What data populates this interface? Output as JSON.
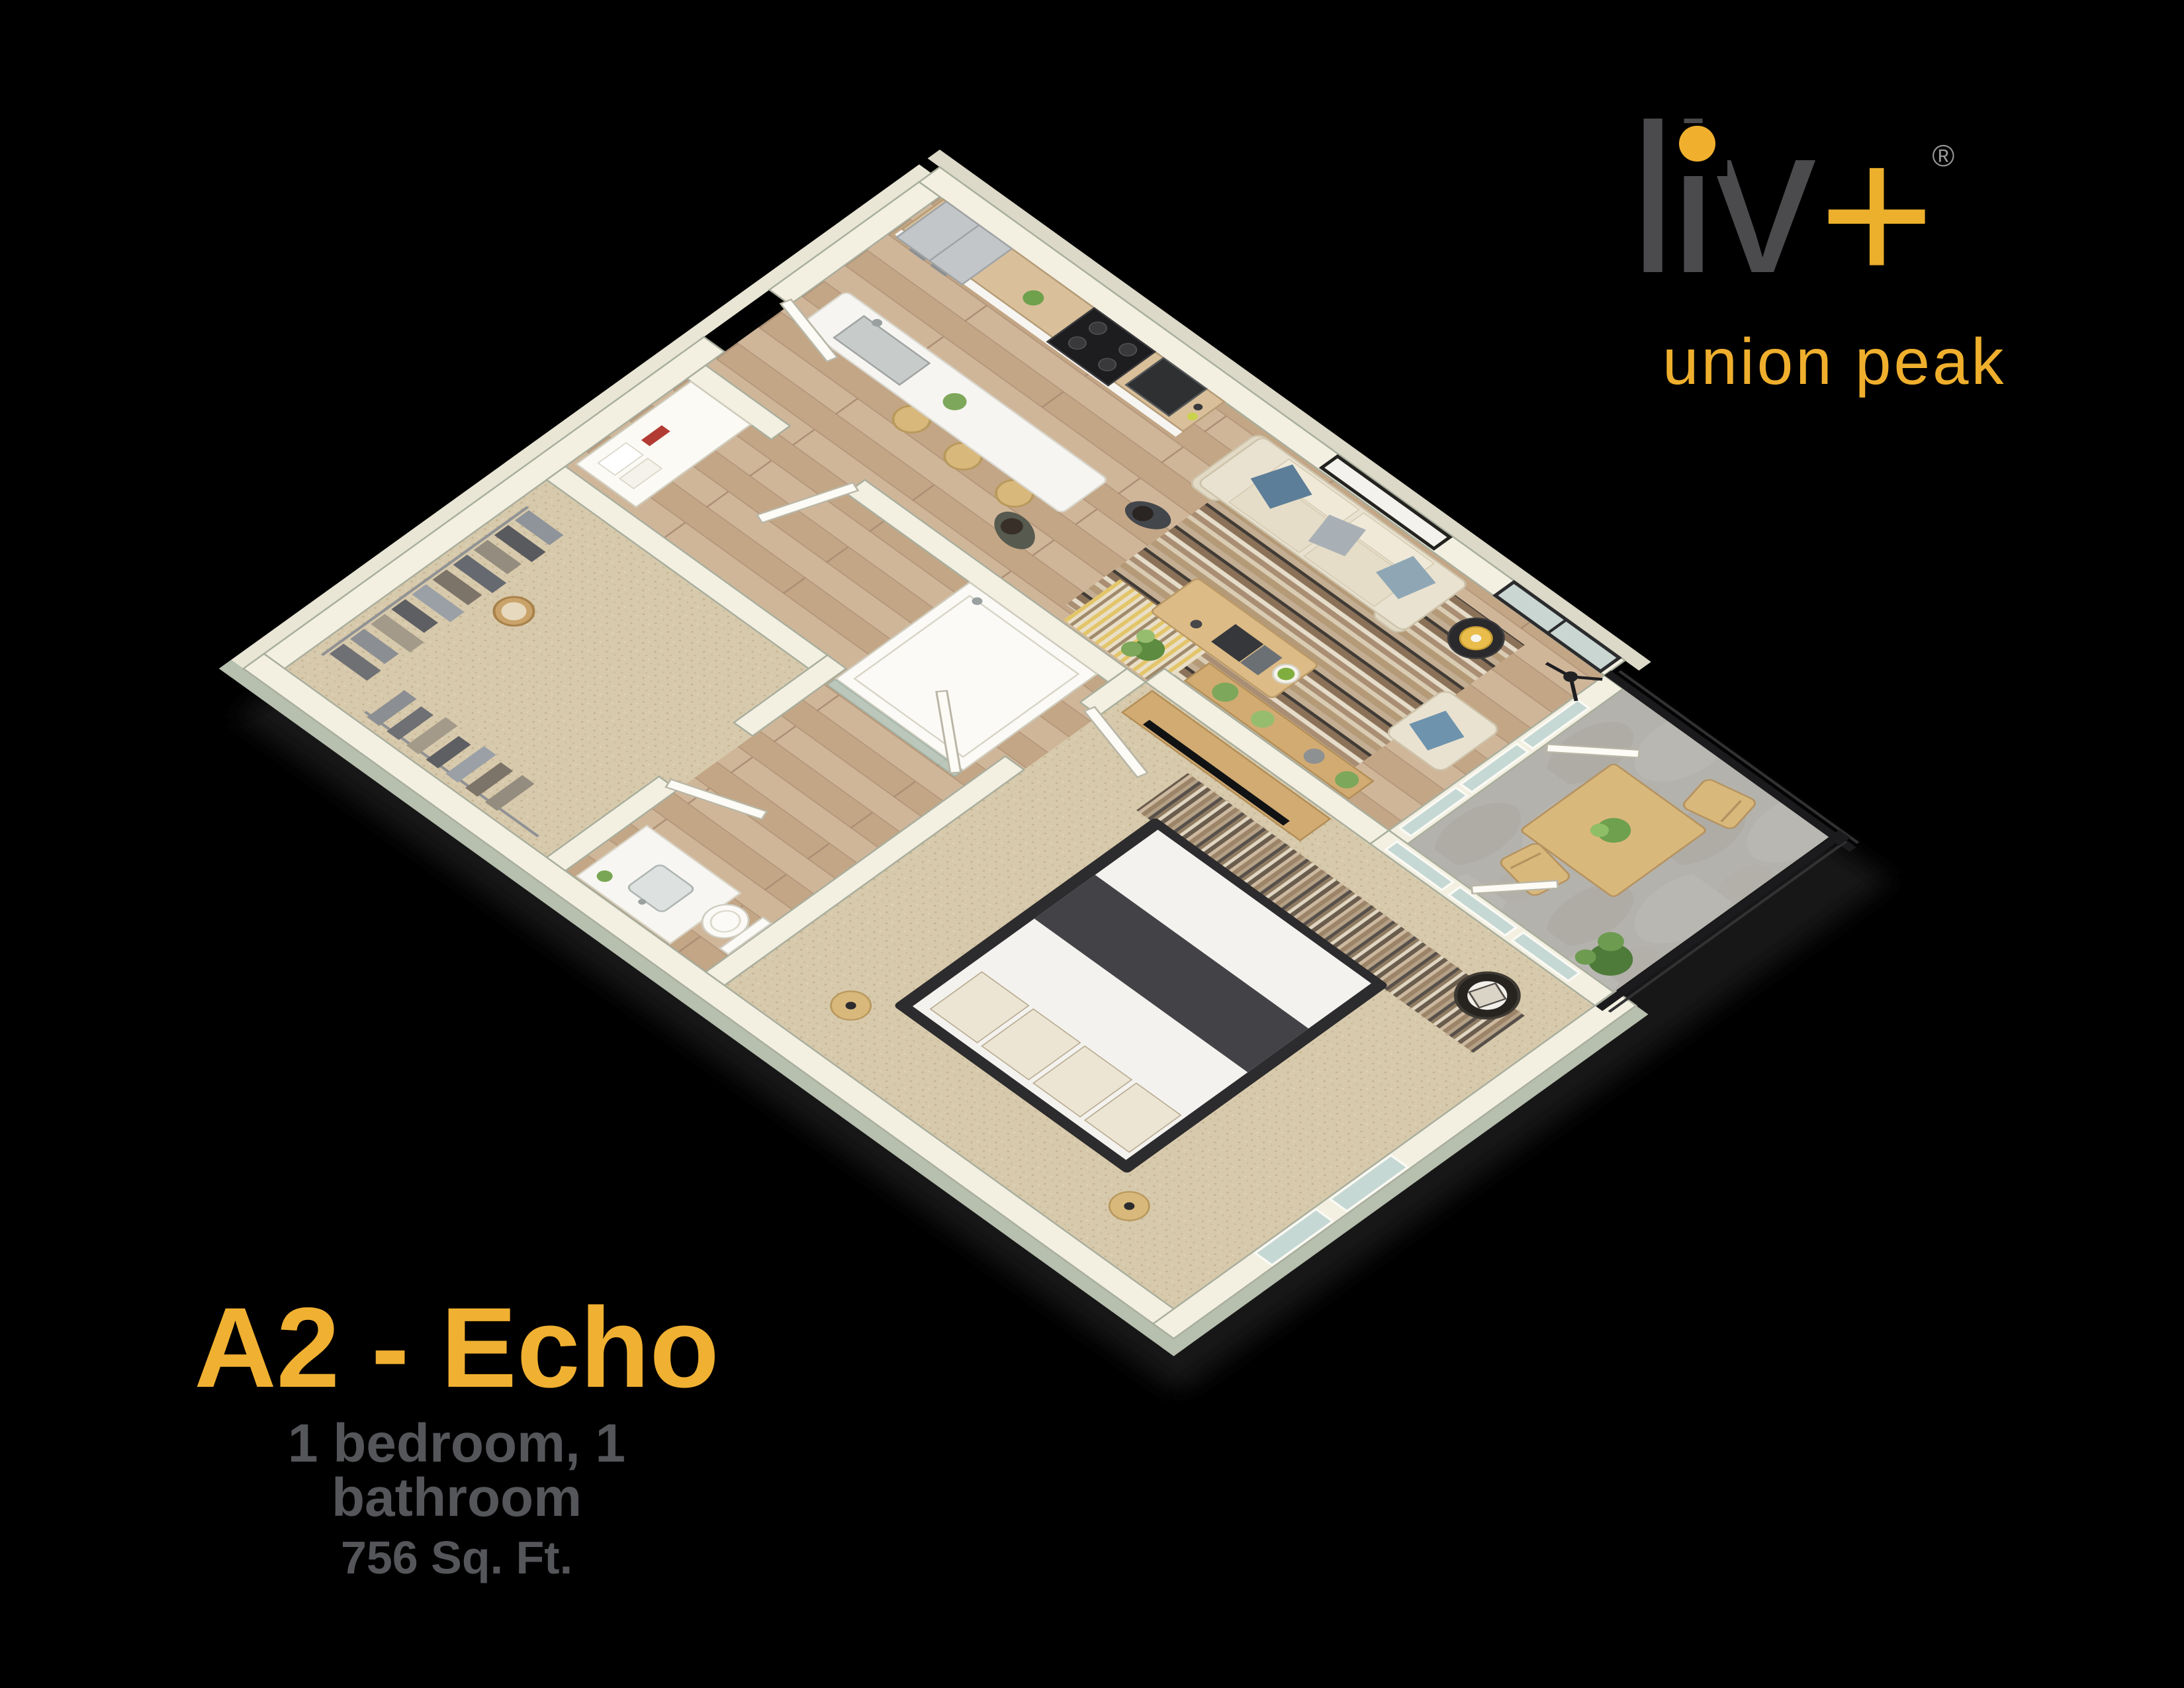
{
  "logo": {
    "name": "liv+",
    "letters": [
      "l",
      "i",
      "v"
    ],
    "plus": "+",
    "registered": "®",
    "subtitle": "union peak"
  },
  "plan": {
    "name": "A2 - Echo",
    "specs": "1 bedroom, 1 bathroom",
    "area": "756 Sq. Ft."
  },
  "colors": {
    "background": "#000000",
    "accent_yellow": "#F0B031",
    "logo_yellow": "#EDB02C",
    "logo_gray": "#4B4A4C",
    "text_gray": "#55565A",
    "wall_cream": "#F3F0E2",
    "wall_shadow_sage": "#B7BFAE",
    "floor_wood": "#C9AE90",
    "carpet_beige": "#D7C9AB",
    "patio_concrete": "#B4B2AC",
    "railing_black": "#1B1B1D",
    "cabinet_wood": "#D9C09A",
    "counter_white": "#F6F5F1",
    "sofa_beige": "#EAE2D0",
    "pillow_blue": "#5D7E98",
    "lamp_yellow": "#E9BC4B",
    "plant_green": "#7DA75A"
  }
}
